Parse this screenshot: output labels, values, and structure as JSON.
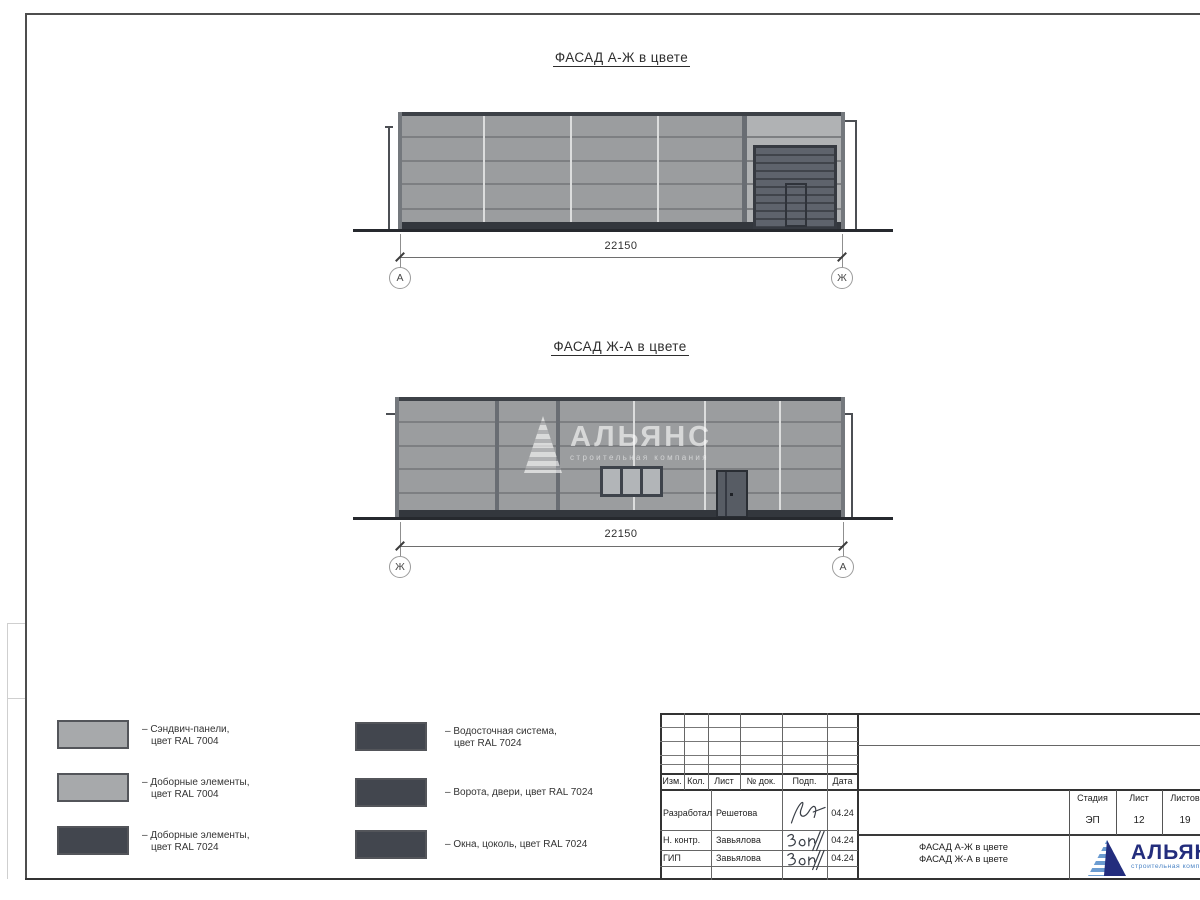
{
  "facade_top": {
    "title": "ФАСАД А-Ж в цвете",
    "dimension": "22150",
    "axis_left": "А",
    "axis_right": "Ж"
  },
  "facade_bottom": {
    "title": "ФАСАД Ж-А в цвете",
    "dimension": "22150",
    "axis_left": "Ж",
    "axis_right": "А"
  },
  "watermark": {
    "name": "АЛЬЯНС",
    "subtitle": "строительная компания"
  },
  "legend": {
    "items": [
      {
        "line1": "– Сэндвич-панели,",
        "line2": "цвет RAL 7004",
        "color": "#a7a9ab"
      },
      {
        "line1": "– Доборные элементы,",
        "line2": "цвет RAL 7004",
        "color": "#a7a9ab"
      },
      {
        "line1": "– Доборные элементы,",
        "line2": "цвет RAL 7024",
        "color": "#42464e"
      },
      {
        "line1": "– Водосточная система,",
        "line2": "цвет RAL 7024",
        "color": "#42464e"
      },
      {
        "line1": "– Ворота, двери, цвет RAL 7024",
        "line2": "",
        "color": "#42464e"
      },
      {
        "line1": "– Окна, цоколь, цвет RAL 7024",
        "line2": "",
        "color": "#42464e"
      }
    ]
  },
  "titleblock": {
    "header": {
      "izm": "Изм.",
      "kol": "Кол.",
      "list": "Лист",
      "ndok": "№ док.",
      "podp": "Подп.",
      "data": "Дата"
    },
    "rows": [
      {
        "role": "Разработал",
        "name": "Решетова",
        "date": "04.24"
      },
      {
        "role": "Н. контр.",
        "name": "Завьялова",
        "date": "04.24"
      },
      {
        "role": "ГИП",
        "name": "Завьялова",
        "date": "04.24"
      }
    ],
    "stage": {
      "label": "Стадия",
      "value": "ЭП"
    },
    "sheet": {
      "label": "Лист",
      "value": "12"
    },
    "sheets": {
      "label": "Листов",
      "value": "19"
    },
    "sheet_name_line1": "ФАСАД А-Ж в цвете",
    "sheet_name_line2": "ФАСАД Ж-А в цвете",
    "logo": {
      "name": "АЛЬЯНС",
      "subtitle": "строительная компания",
      "navy": "#232d7d",
      "blue": "#6b9cd1"
    }
  },
  "colors": {
    "ral7004_panel": "#9b9d9f",
    "ral7004_light_bay": "#b0b2b4",
    "ral7024_dark": "#42464e",
    "joint_dark": "#7d7f82",
    "joint_light": "#dcdddd",
    "trim_dark": "#3d4147",
    "ground": "#26292e"
  }
}
